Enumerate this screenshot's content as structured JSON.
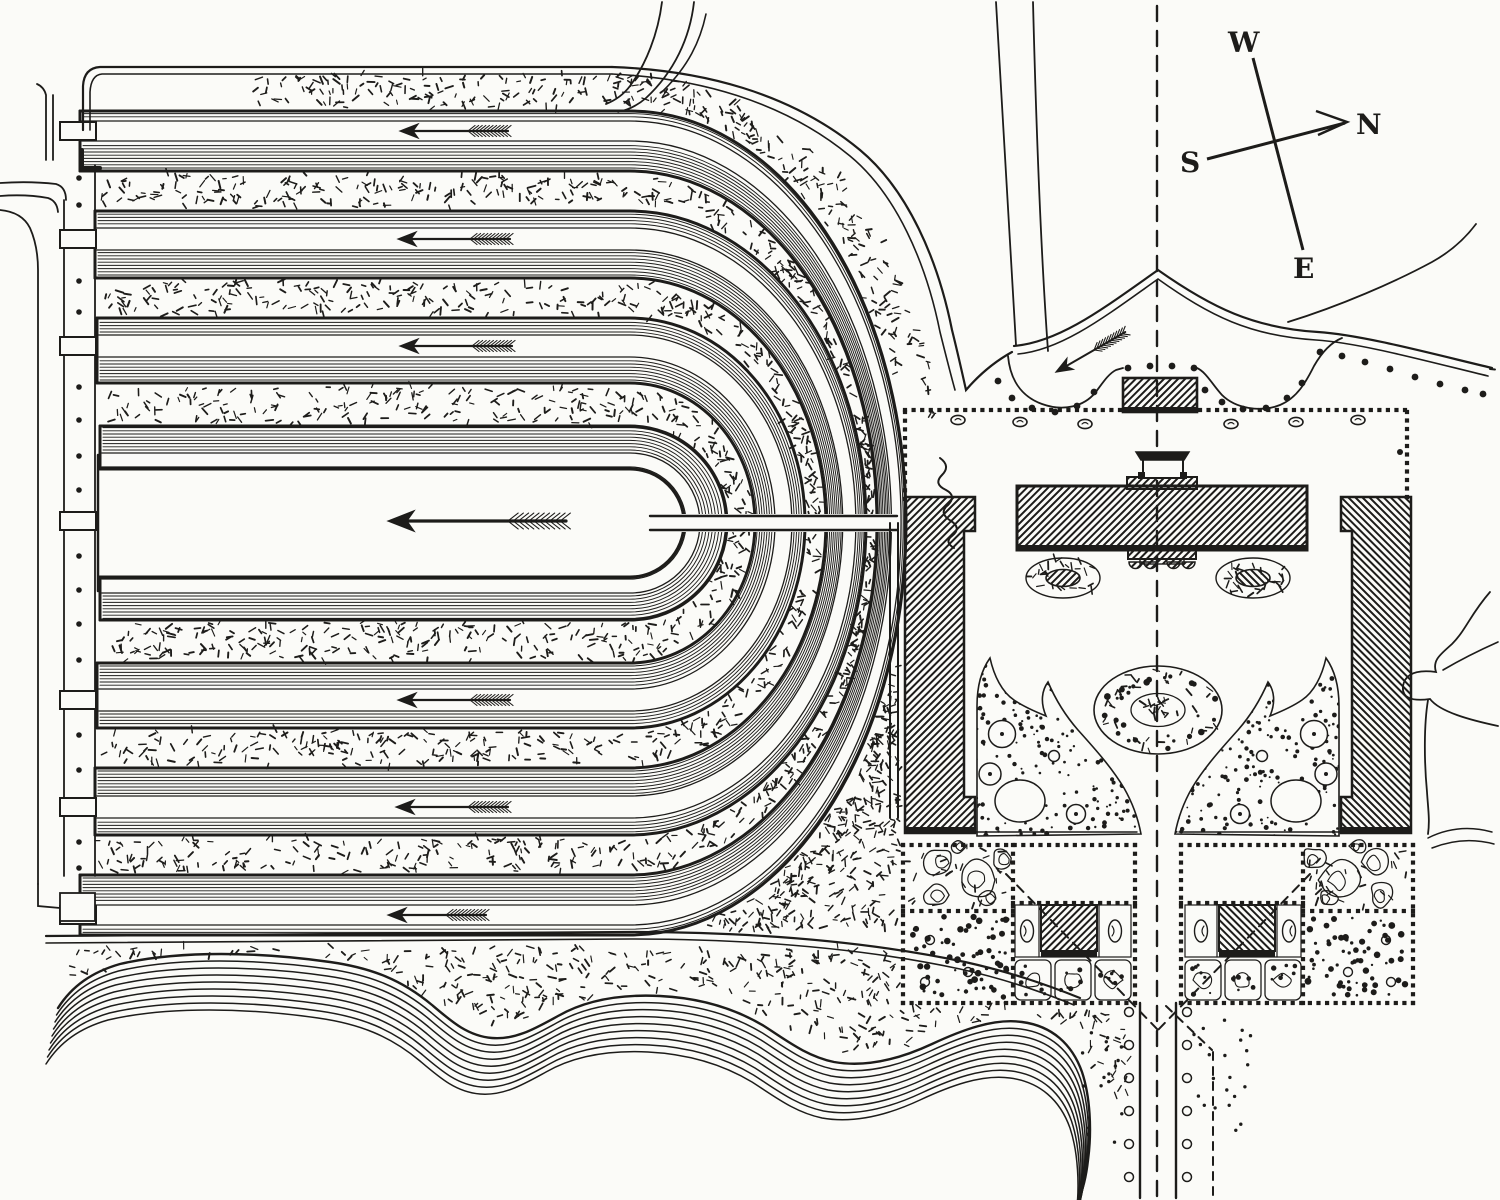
{
  "figure": {
    "compass": {
      "west": "W",
      "north": "N",
      "south": "S",
      "east": "E"
    },
    "flow_direction_arrow_count": 7,
    "colors": {
      "ink": "#1d1c1a",
      "paper": "#fbfbf8"
    },
    "icons": {
      "flow_arrow": "feathered-arrow-left-icon",
      "road_arrow": "feathered-arrow-curve-icon",
      "compass_needle": "compass-needle-icon",
      "annotation": "cursive-scribble-icon"
    }
  }
}
